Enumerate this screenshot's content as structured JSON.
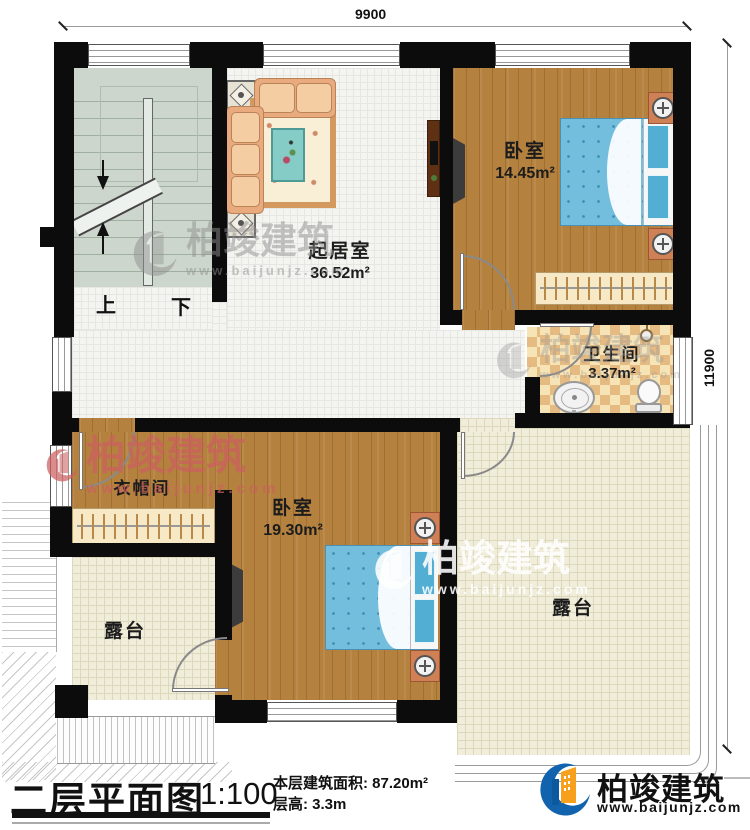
{
  "dimensions": {
    "width_top": "9900",
    "height_right": "11900"
  },
  "stairs": {
    "up": "上",
    "down": "下"
  },
  "rooms": {
    "living": {
      "name": "起居室",
      "area": "36.52m²"
    },
    "bedroom1": {
      "name": "卧室",
      "area": "14.45m²"
    },
    "bathroom": {
      "name": "卫生间",
      "area": "3.37m²"
    },
    "cloakroom": {
      "name": "衣帽间"
    },
    "bedroom2": {
      "name": "卧室",
      "area": "19.30m²"
    },
    "terrace_left": {
      "name": "露台"
    },
    "terrace_right": {
      "name": "露台"
    }
  },
  "footer": {
    "plan_title": "二层平面图",
    "scale": "1:100",
    "area_line": "本层建筑面积: 87.20m²",
    "height_line": "层高: 3.3m"
  },
  "brand": {
    "name": "柏竣建筑",
    "url": "www.baijunjz.com"
  },
  "colors": {
    "logo_blue": "#1063ac",
    "logo_orange": "#f6a01d",
    "watermark_red": "#cc5f5f"
  }
}
